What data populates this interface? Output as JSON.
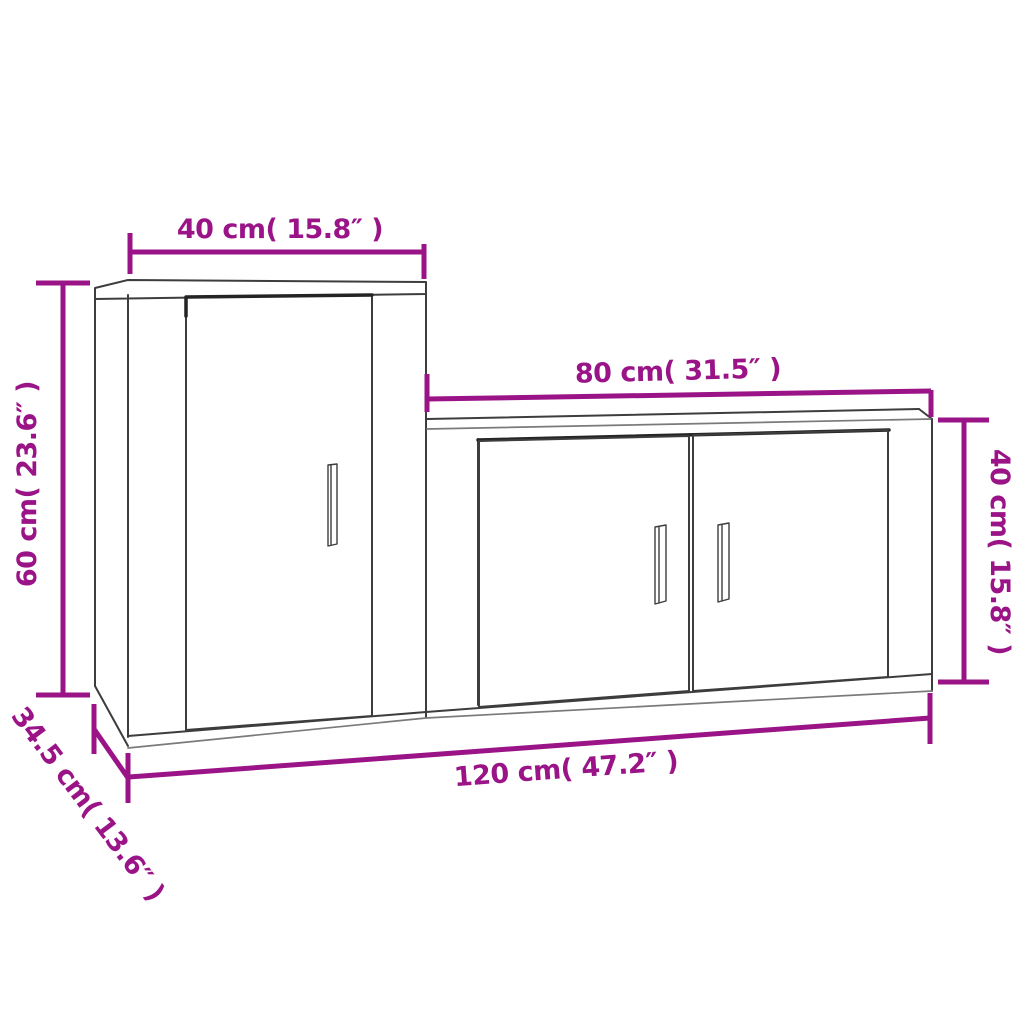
{
  "diagram": {
    "accent_color": "#9a1487",
    "line_color": "#3d3d3d",
    "background_color": "#ffffff",
    "subject": "two-piece wall cabinet set dimension drawing",
    "labels": {
      "left_cabinet_width": "40 cm( 15.8″ )",
      "left_cabinet_height": "60 cm( 23.6″ )",
      "right_cabinet_width": "80 cm( 31.5″ )",
      "right_cabinet_height": "40 cm( 15.8″ )",
      "total_width": "120 cm( 47.2″ )",
      "depth": "34.5 cm( 13.6″ )"
    }
  }
}
